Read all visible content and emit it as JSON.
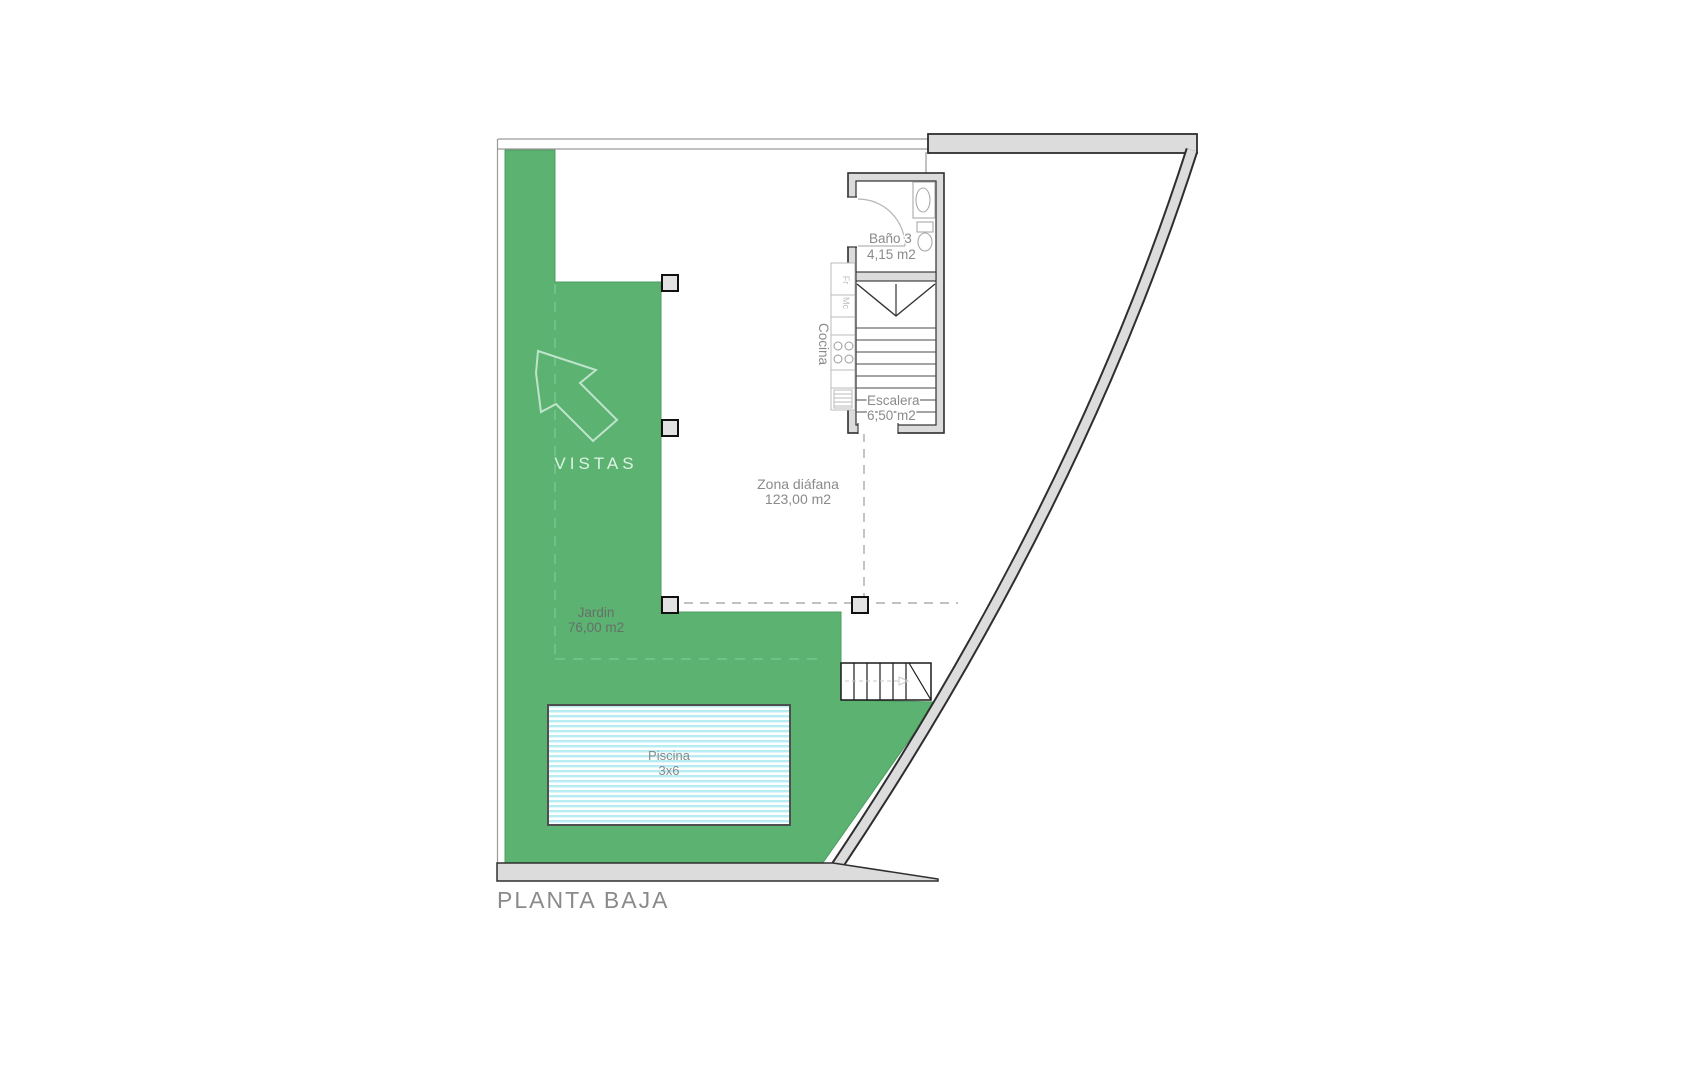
{
  "title": "PLANTA BAJA",
  "rooms": {
    "bano": {
      "name": "Baño 3",
      "area": "4,15 m2"
    },
    "escalera": {
      "name": "Escalera",
      "area": "6,50 m2"
    },
    "cocina": {
      "name": "Cocina"
    },
    "zona": {
      "name": "Zona diáfana",
      "area": "123,00 m2"
    },
    "jardin": {
      "name": "Jardin",
      "area": "76,00 m2"
    },
    "piscina": {
      "name": "Piscina",
      "size": "3x6"
    },
    "vistas": {
      "name": "VISTAS"
    }
  },
  "appliances": {
    "fridge": "Fr",
    "microwave": "Mc"
  },
  "colors": {
    "garden_green": "#5BB271",
    "wall_fill": "#DCDCDC",
    "wall_stroke": "#2E2E2E",
    "boundary_line": "#9A9A9A",
    "label_gray": "#8A8A8A",
    "pool_stripe": "#B7ECF2",
    "pool_border": "#4F4F4F",
    "pillar_fill": "#E2E2E2",
    "vistas_text": "#DFF3E4",
    "arrow_outline": "#BFE4CB",
    "garden_dash": "#86CC9C",
    "zone_dash": "#9E9E9E"
  }
}
